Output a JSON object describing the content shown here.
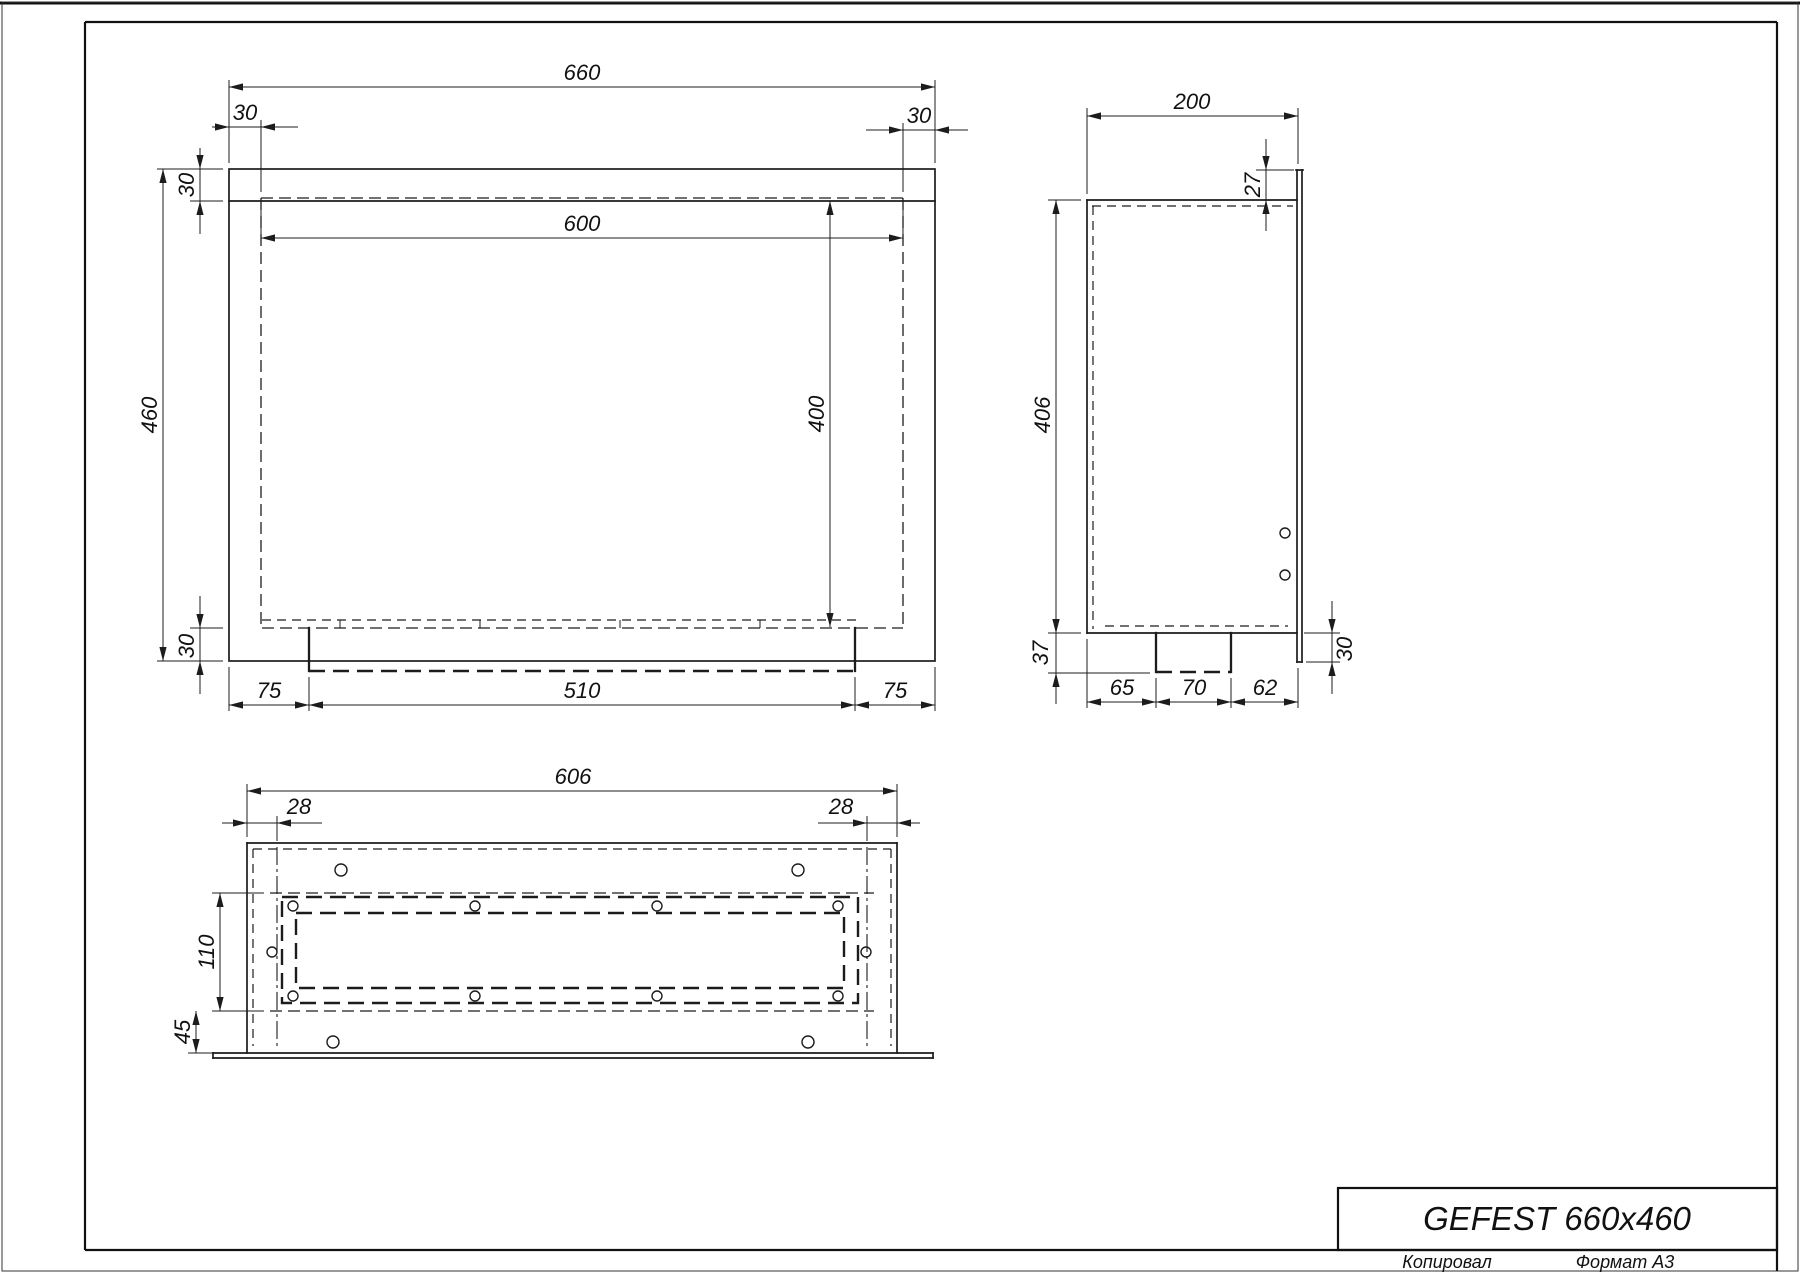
{
  "sheet": {
    "copied_label": "Копировал",
    "format_label": "Формат А3"
  },
  "title_block": {
    "title": "GEFEST 660x460"
  },
  "front_view": {
    "dims": {
      "overall_width": "660",
      "flange_left": "30",
      "flange_right": "30",
      "flange_top": "30",
      "overall_height": "460",
      "flange_bottom": "30",
      "opening_width": "600",
      "opening_height": "400",
      "tray_offset_left": "75",
      "tray_width": "510",
      "tray_offset_right": "75"
    }
  },
  "side_view": {
    "dims": {
      "depth": "200",
      "flange_lip_top": "27",
      "body_height": "406",
      "tray_drop": "37",
      "foot_offset_front": "65",
      "foot_width": "70",
      "foot_offset_back": "62",
      "flange_lip_bottom": "30"
    }
  },
  "bottom_view": {
    "dims": {
      "overall_width": "606",
      "fold_left": "28",
      "fold_right": "28",
      "recess_height": "110",
      "front_band": "45"
    }
  }
}
